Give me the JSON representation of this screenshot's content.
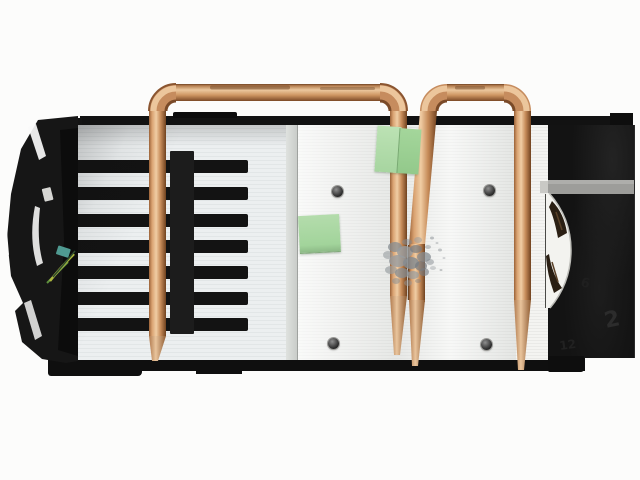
{
  "meta": {
    "type": "product-photo",
    "subject": "Graphics card cooling assembly seen from the side/top: aluminum fin stacks, two exposed copper heatpipe loops, black plastic fan shroud ends, green masking-tape tabs and a smear of gray thermal paste",
    "background_color": "#fcfcfb"
  },
  "palette": {
    "copper_highlight": "#f0cda4",
    "copper_mid": "#c98d5e",
    "copper_shadow": "#70421f",
    "aluminum_left_fins": "#e8ecec",
    "aluminum_center": "#f2f3f1",
    "black_plastic": "#141414",
    "stripe_gray": "#a0a09d",
    "note_green": "#a9d8a2",
    "paste_gray": "#8b9196",
    "fan_ring_white": "#f3f3ef"
  },
  "components": {
    "left_bracket": "black angular mounting bracket",
    "left_fins": "white finned vent section with seven black slots",
    "center_block": "brushed aluminum heatsink block with four screws",
    "heatpipe_large_loop": "large copper heatpipe loop",
    "heatpipe_small_loop": "small copper heatpipe loop",
    "thermal_paste": "gray thermal paste speckle",
    "fan": "white fan ring visible through shroud cutout",
    "shroud": "black plastic shroud with gray stripe"
  },
  "shroud": {
    "embossed_text": "2",
    "embossed_text_2": "6",
    "embossed_text_3": "12"
  }
}
